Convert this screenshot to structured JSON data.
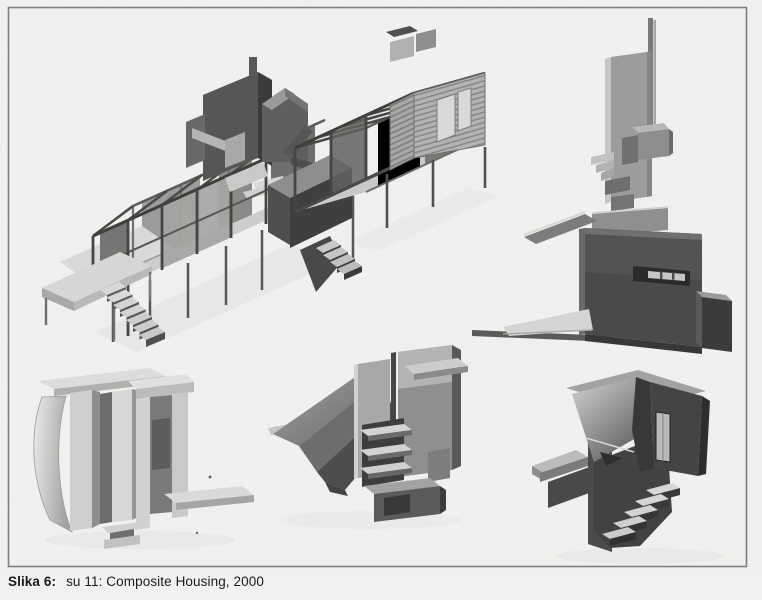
{
  "caption": {
    "label": "Slika 6:",
    "text": "su 11: Composite Housing, 2000"
  },
  "figure": {
    "alt": "Six grayscale 3D renderings of prefabricated composite housing modules",
    "items": [
      {
        "name": "main-house-assembly"
      },
      {
        "name": "mast-wall-module"
      },
      {
        "name": "slot-wall-ramp-module"
      },
      {
        "name": "curved-pod-module"
      },
      {
        "name": "ramp-shelf-module"
      },
      {
        "name": "stair-tower-module"
      }
    ]
  },
  "colors": {
    "paper": "#f1f1ef",
    "frame_border": "#7e7e7c",
    "ink": "#1b1b1b",
    "render_dark": "#4a4947",
    "render_mid": "#8f8f8d",
    "render_light": "#d6d6d4"
  }
}
